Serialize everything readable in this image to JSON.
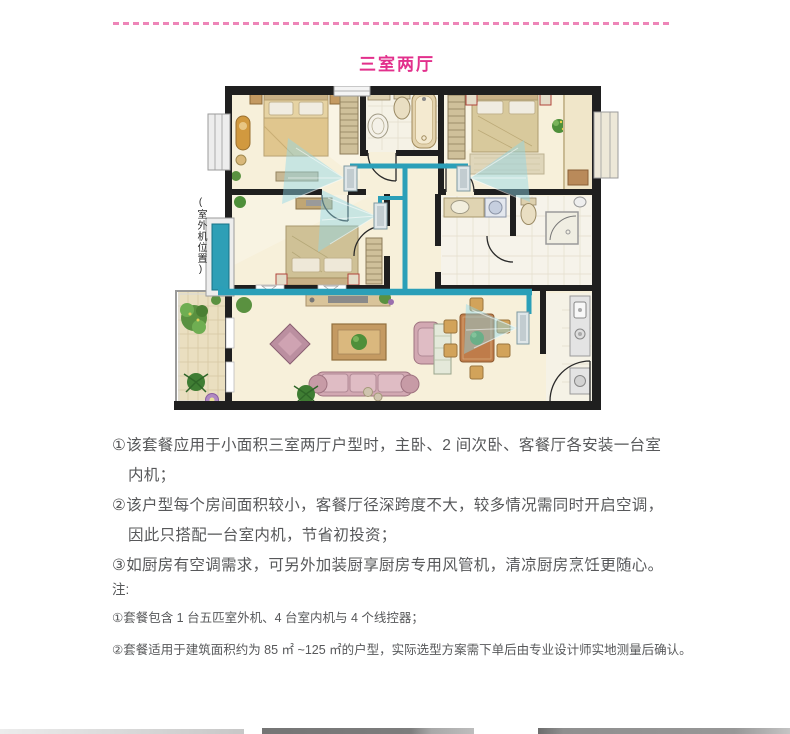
{
  "header": {
    "title": "三室两厅",
    "title_color": "#e2308c"
  },
  "floor_plan": {
    "outdoor_unit_label": "(室外机位置)",
    "pipe_color": "#2b9fb8",
    "wall_color": "#1f1f1f",
    "floor_color": "#f7f0da"
  },
  "description": {
    "paragraphs": [
      [
        "①该套餐应用于小面积三室两厅户型时，主卧、2 间次卧、客餐厅各安装一台室",
        "内机；"
      ],
      [
        "②该户型每个房间面积较小，客餐厅径深跨度不大，较多情况需同时开启空调，",
        "因此只搭配一台室内机，节省初投资；"
      ],
      [
        "③如厨房有空调需求，可另外加装厨享厨房专用风管机，清凉厨房烹饪更随心。"
      ]
    ]
  },
  "notes": {
    "label": "注:",
    "items": [
      "①套餐包含 1 台五匹室外机、4 台室内机与 4 个线控器；",
      "②套餐适用于建筑面积约为 85 ㎡ ~125 ㎡的户型，实际选型方案需下单后由专业设计师实地测量后确认。"
    ]
  }
}
